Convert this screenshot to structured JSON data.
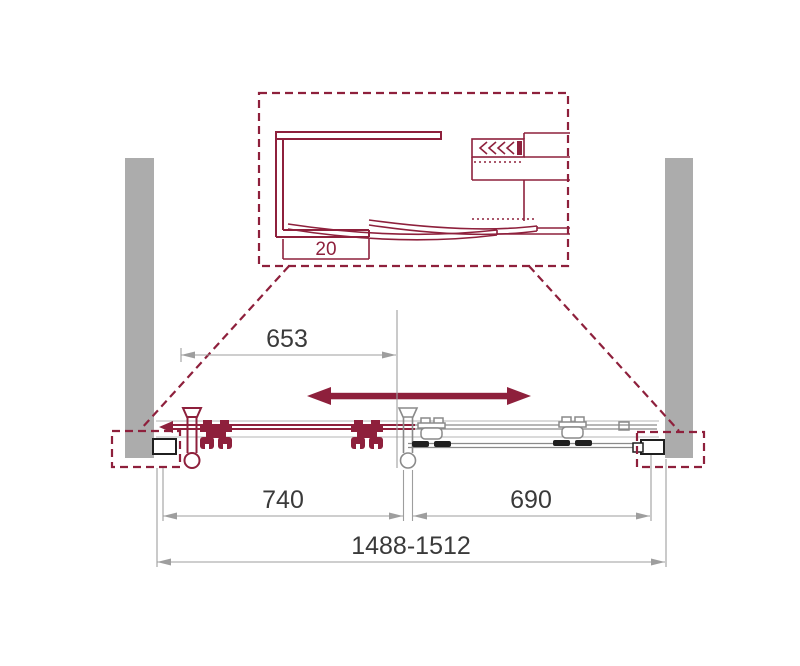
{
  "detail_view": {
    "profile_depth": {
      "value": "20"
    }
  },
  "dimensions": {
    "opening_width": {
      "value": "653"
    },
    "door_panel_left": {
      "value": "740"
    },
    "door_panel_right": {
      "value": "690"
    },
    "overall_range": {
      "value": "1488-1512"
    }
  },
  "colors": {
    "accent_red": "#8E203C",
    "wall_gray": "#ACACAC",
    "dim_line_gray": "#9E9E9E",
    "text_dark": "#3A3A3A",
    "component_gray": "#8A8A8A",
    "component_dark": "#1F1F1F",
    "background": "#FFFFFF"
  }
}
